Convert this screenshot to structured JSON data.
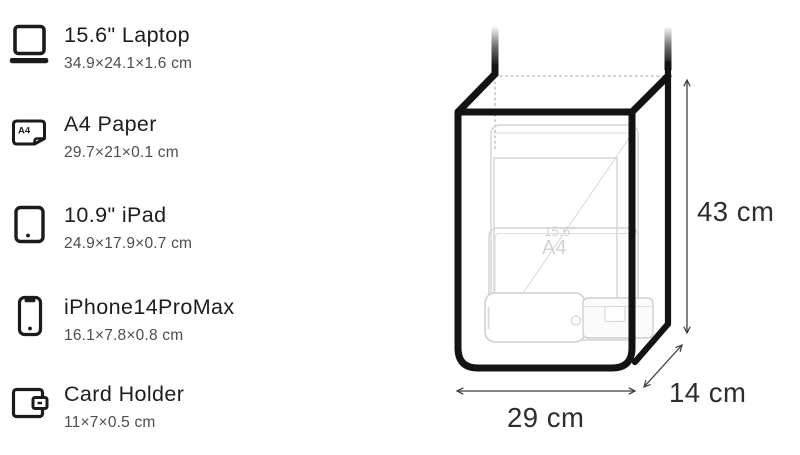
{
  "items": [
    {
      "name": "15.6\" Laptop",
      "dims": "34.9×24.1×1.6 cm"
    },
    {
      "name": "A4 Paper",
      "dims": "29.7×21×0.1 cm"
    },
    {
      "name": "10.9\" iPad",
      "dims": "24.9×17.9×0.7 cm"
    },
    {
      "name": "iPhone14ProMax",
      "dims": "16.1×7.8×0.8 cm"
    },
    {
      "name": "Card Holder",
      "dims": "11×7×0.5 cm"
    }
  ],
  "icon_names": [
    "laptop-icon",
    "a4-paper-icon",
    "ipad-icon",
    "iphone-icon",
    "card-holder-icon"
  ],
  "a4_icon_text": "A4",
  "diagram": {
    "height_label": "43 cm",
    "width_label": "29 cm",
    "depth_label": "14 cm",
    "laptop_ghost_label": "15.6\"",
    "a4_ghost_label": "A4",
    "colors": {
      "outline": "#131313",
      "ghost": "#d3d3d3",
      "dotted": "#c2c2c2",
      "arrow": "#3f3f3f",
      "label": "#2d2d2d"
    }
  }
}
